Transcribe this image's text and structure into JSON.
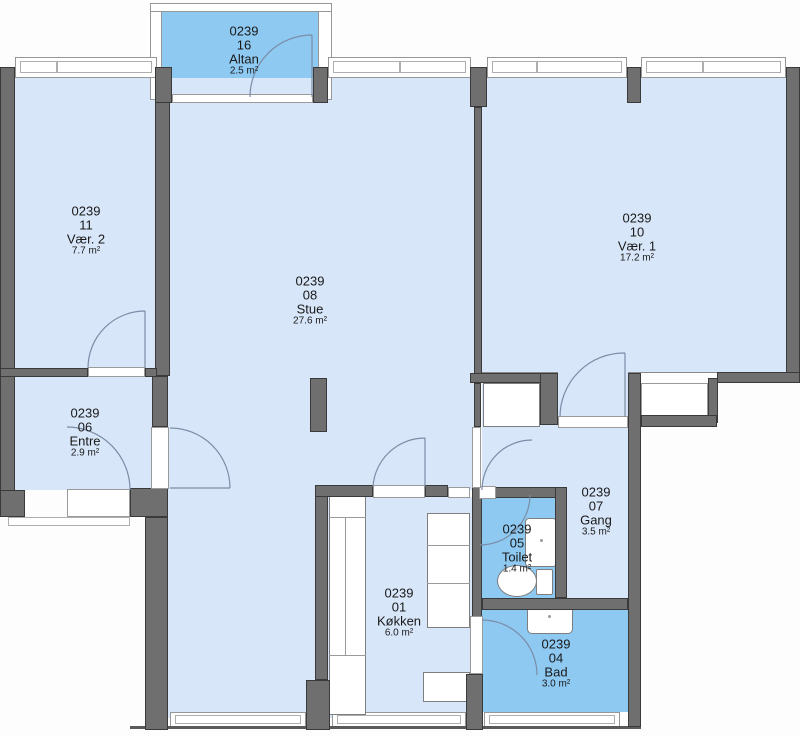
{
  "plan_title": "Apartment floor plan 0239",
  "rooms": [
    {
      "key": "altan",
      "unit": "0239",
      "number": "16",
      "name": "Altan",
      "area": "2.5 m²"
    },
    {
      "key": "vaer2",
      "unit": "0239",
      "number": "11",
      "name": "Vær. 2",
      "area": "7.7 m²"
    },
    {
      "key": "stue",
      "unit": "0239",
      "number": "08",
      "name": "Stue",
      "area": "27.6 m²"
    },
    {
      "key": "vaer1",
      "unit": "0239",
      "number": "10",
      "name": "Vær. 1",
      "area": "17.2 m²"
    },
    {
      "key": "entre",
      "unit": "0239",
      "number": "06",
      "name": "Entre",
      "area": "2.9 m²"
    },
    {
      "key": "gang",
      "unit": "0239",
      "number": "07",
      "name": "Gang",
      "area": "3.5 m²"
    },
    {
      "key": "toilet",
      "unit": "0239",
      "number": "05",
      "name": "Toilet",
      "area": "1.4 m²"
    },
    {
      "key": "koekken",
      "unit": "0239",
      "number": "01",
      "name": "Køkken",
      "area": "6.0 m²"
    },
    {
      "key": "bad",
      "unit": "0239",
      "number": "04",
      "name": "Bad",
      "area": "3.0 m²"
    }
  ],
  "colors": {
    "room_fill": "#d8e6f9",
    "wet_room_fill": "#8ec9f1",
    "wall": "#6f6f6f",
    "wall_outline": "#3a3a3a",
    "window_line": "#979797",
    "door_arc": "#7b8da6",
    "label_text": "#191919"
  }
}
